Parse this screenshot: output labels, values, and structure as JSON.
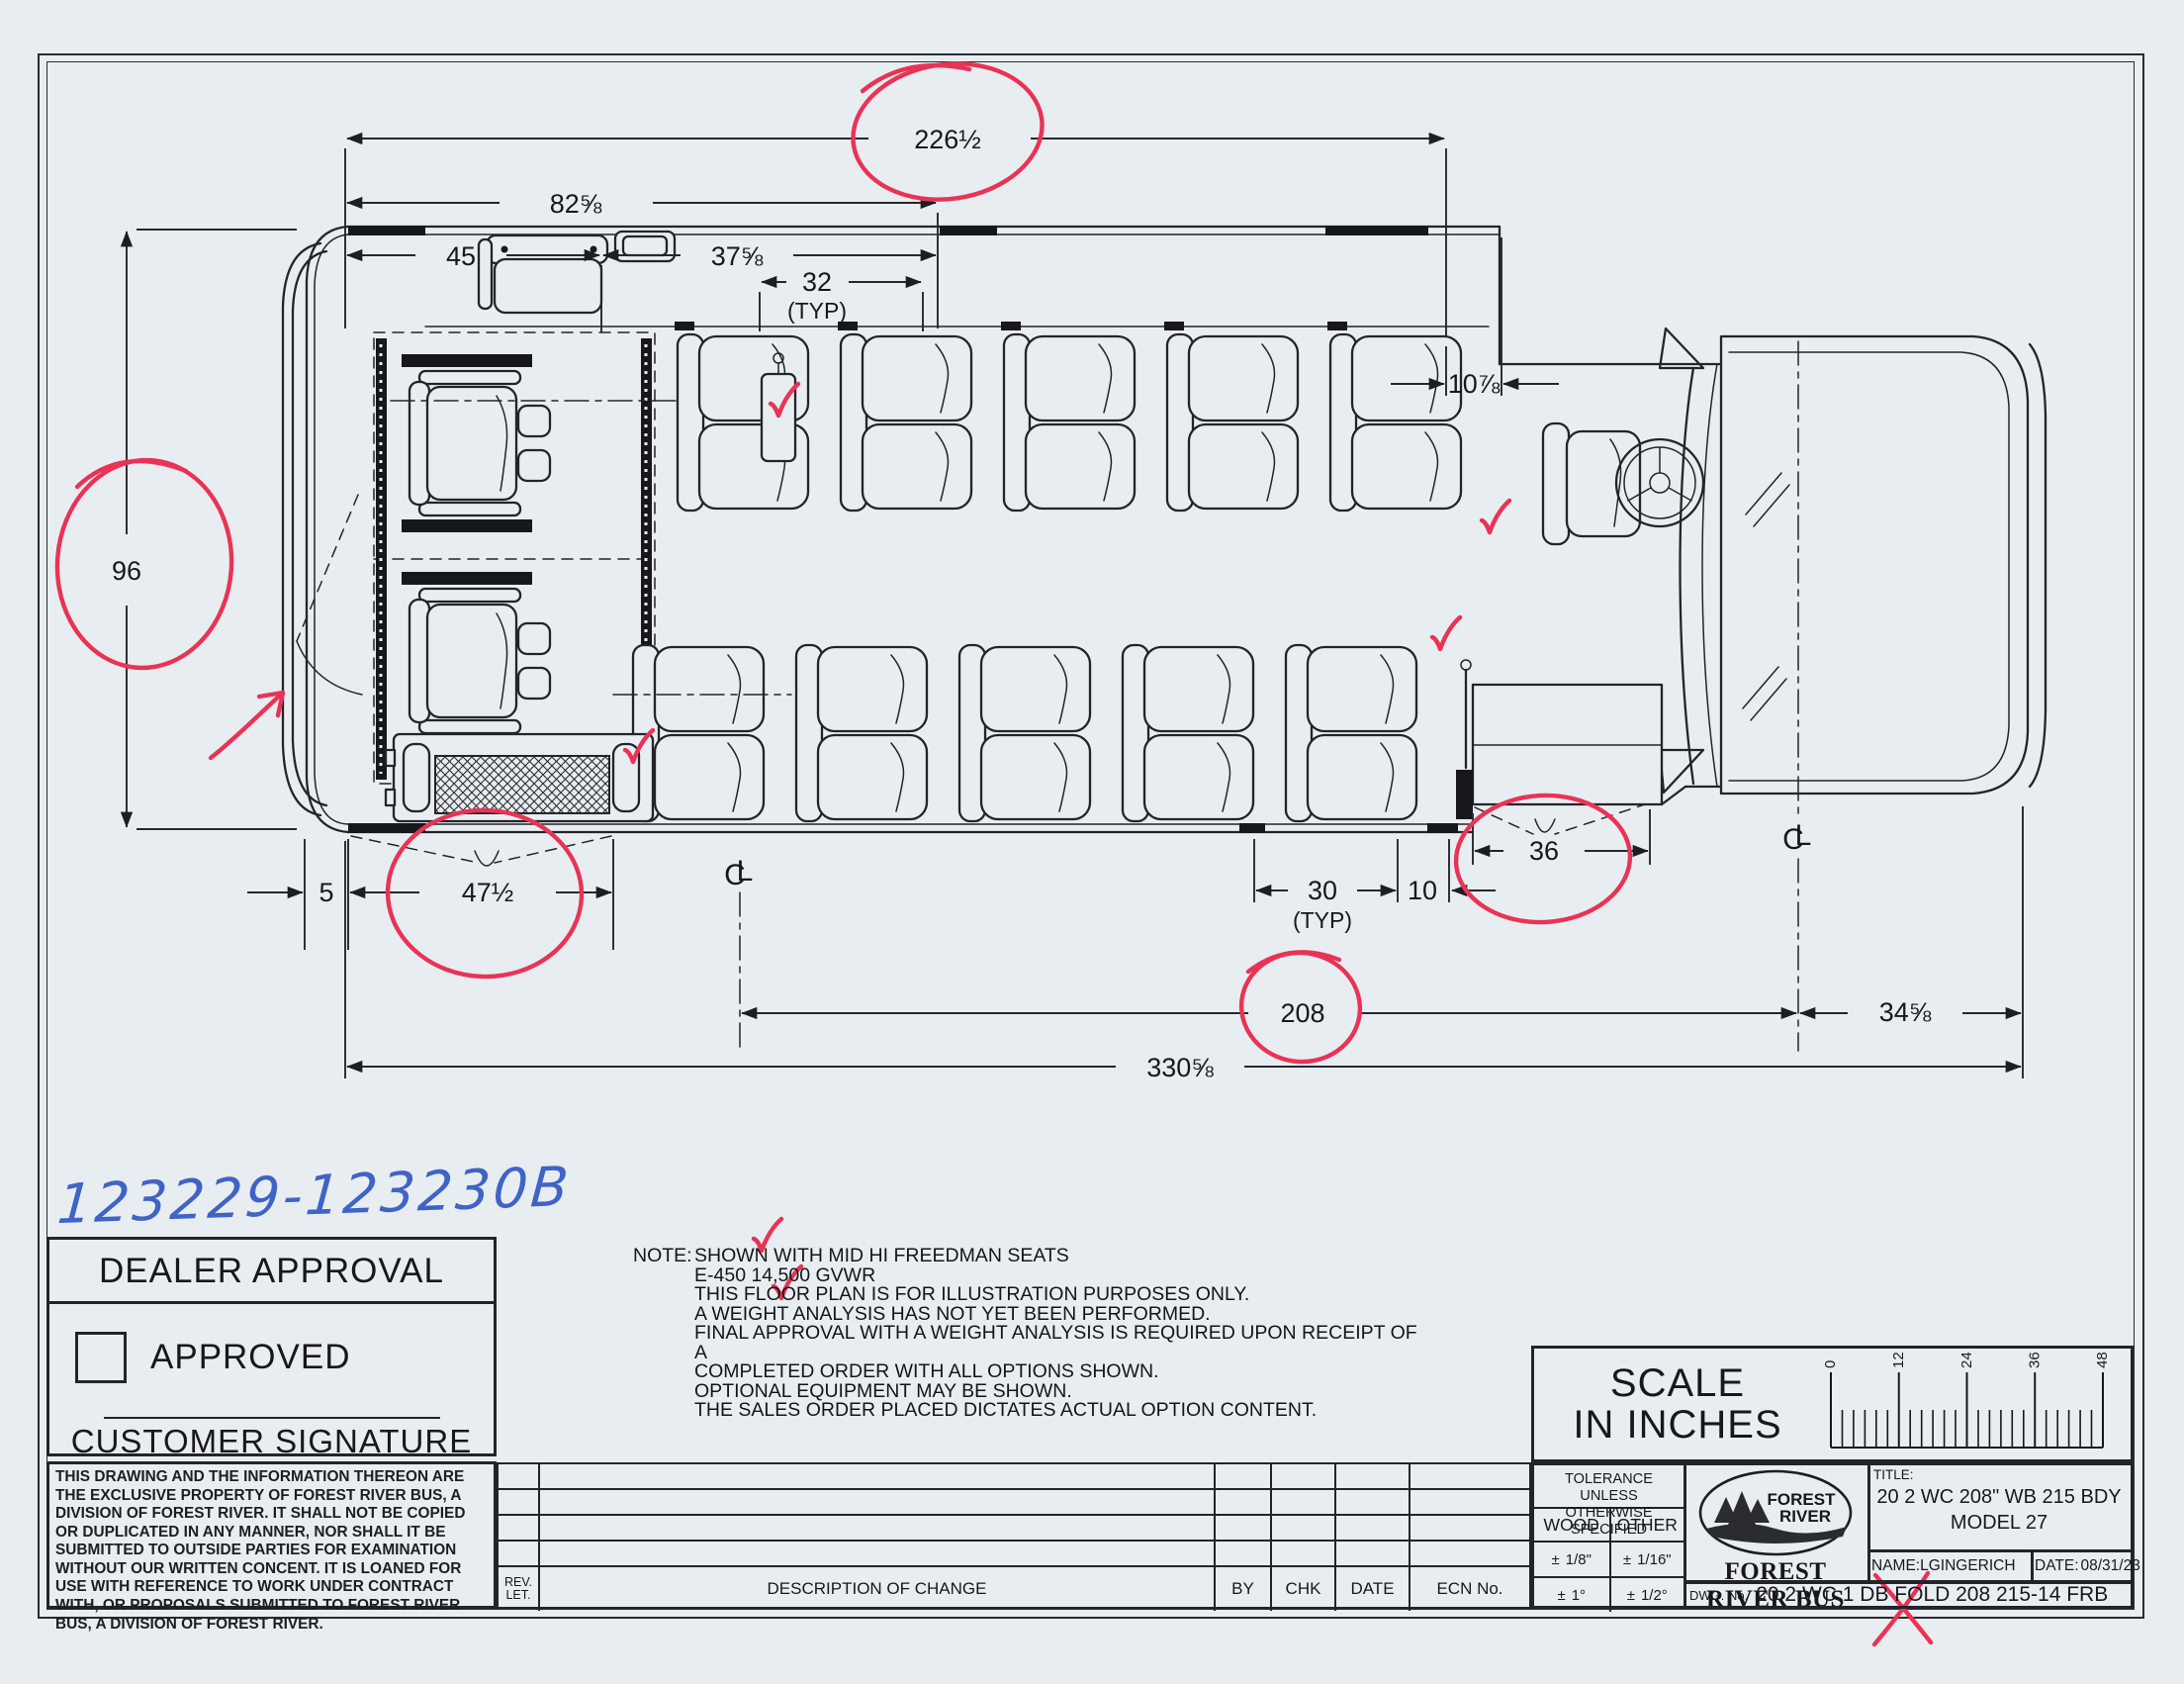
{
  "handwriting": {
    "job_number": "123229-123230B"
  },
  "dealer_approval": {
    "title": "DEALER APPROVAL",
    "approved_label": "APPROVED",
    "signature_label": "CUSTOMER SIGNATURE"
  },
  "legal": {
    "text": "THIS DRAWING AND THE INFORMATION THEREON ARE THE EXCLUSIVE PROPERTY OF FOREST RIVER BUS, A DIVISION OF FOREST RIVER. IT SHALL NOT BE COPIED OR DUPLICATED IN ANY MANNER, NOR SHALL IT BE SUBMITTED TO OUTSIDE PARTIES FOR EXAMINATION WITHOUT OUR WRITTEN CONCENT. IT IS LOANED FOR USE WITH REFERENCE TO WORK UNDER CONTRACT WITH, OR PROPOSALS SUBMITTED TO FOREST RIVER BUS, A DIVISION OF FOREST RIVER."
  },
  "note": {
    "label": "NOTE:",
    "lines": [
      "SHOWN WITH MID HI FREEDMAN SEATS",
      "E-450 14,500 GVWR",
      "THIS FLOOR PLAN IS  FOR ILLUSTRATION PURPOSES ONLY.",
      "A WEIGHT ANALYSIS HAS NOT YET BEEN PERFORMED.",
      "FINAL APPROVAL WITH A WEIGHT ANALYSIS IS REQUIRED UPON RECEIPT OF A",
      "COMPLETED ORDER WITH ALL OPTIONS SHOWN.",
      "OPTIONAL EQUIPMENT MAY BE SHOWN.",
      "THE SALES ORDER PLACED DICTATES ACTUAL OPTION CONTENT."
    ]
  },
  "revision_table": {
    "rev_label": "REV.",
    "let_label": "LET.",
    "description": "DESCRIPTION OF CHANGE",
    "by": "BY",
    "chk": "CHK",
    "date": "DATE",
    "ecn": "ECN No."
  },
  "tolerance": {
    "line1": "TOLERANCE UNLESS",
    "line2": "OTHERWISE SPECIFIED",
    "wood": "WOOD",
    "other": "OTHER",
    "pm": "±",
    "wood_lin": "1/8\"",
    "other_lin": "1/16\"",
    "wood_ang": "1°",
    "other_ang": "1/2°"
  },
  "title_block": {
    "title_label": "TITLE:",
    "line1": "20 2 WC 208\" WB 215 BDY",
    "line2": "MODEL 27",
    "company": "FOREST RIVER BUS",
    "logo_line1": "FOREST",
    "logo_line2": "RIVER",
    "name_label": "NAME:",
    "name": "LGINGERICH",
    "date_label": "DATE:",
    "date": "08/31/23",
    "dwg_label": "DWG. No.",
    "dwg": "20 2 WC 1 DB FOLD 208 215-14 FRB"
  },
  "scale": {
    "line1": "SCALE",
    "line2": "IN INCHES",
    "ticks": [
      "0",
      "12",
      "24",
      "36",
      "48"
    ]
  },
  "dims": {
    "overall_body": "226½",
    "rear_to_wc_end": "82⅝",
    "rear_seg": "45",
    "wc_seg": "37⅝",
    "seat_pitch_top": "32",
    "typ": "(TYP)",
    "cowl_gap": "10⅞",
    "body_width": "96",
    "bumper_gap": "5",
    "rear_door_opening": "47½",
    "seat_pitch_bottom": "30",
    "door_gap": "10",
    "entry_door": "36",
    "wheelbase": "208",
    "front_overhang": "34⅝",
    "overall_length": "330⅝",
    "cl_c": "C",
    "cl_l": "L"
  }
}
